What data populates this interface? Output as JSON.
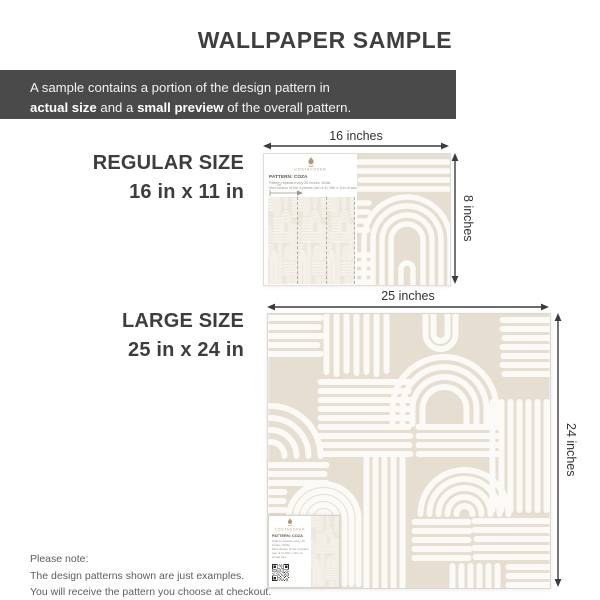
{
  "title": "WALLPAPER SAMPLE",
  "banner": {
    "line1": "A sample contains a portion of the design pattern in",
    "bold1": "actual size",
    "sep": " and a ",
    "bold2": "small preview",
    "tail": " of the overall pattern."
  },
  "sections": {
    "regular": {
      "name": "REGULAR SIZE",
      "size": "16 in x 11 in",
      "width_label": "16 inches",
      "height_label": "8 inches"
    },
    "large": {
      "name": "LARGE SIZE",
      "size": "25 in x 24 in",
      "width_label": "25 inches",
      "height_label": "24 inches"
    }
  },
  "sample_info": {
    "brand": "COSTACOVER",
    "pattern_name": "PATTERN: COZA",
    "fineprint1": "Pattern repeats every 25 inches. White",
    "fineprint2": "Mini version of the 4 panels (set of 4) 25in x 11in of actual size",
    "ruler_label": "25\""
  },
  "note": {
    "line1": "Please note:",
    "line2": "The design patterns shown are just examples.",
    "line3": "You will receive the pattern you choose at checkout."
  },
  "icons": {
    "logo": "costacover-crest-icon",
    "qr": "qr-code"
  },
  "colors": {
    "pattern_beige": "#e5ded1",
    "pattern_line": "#fbfaf6",
    "banner_background": "#4a4a4a",
    "brand_gold": "#b0976e",
    "text_dark": "#3d3d3d",
    "note_gray": "#5e5e5e"
  }
}
